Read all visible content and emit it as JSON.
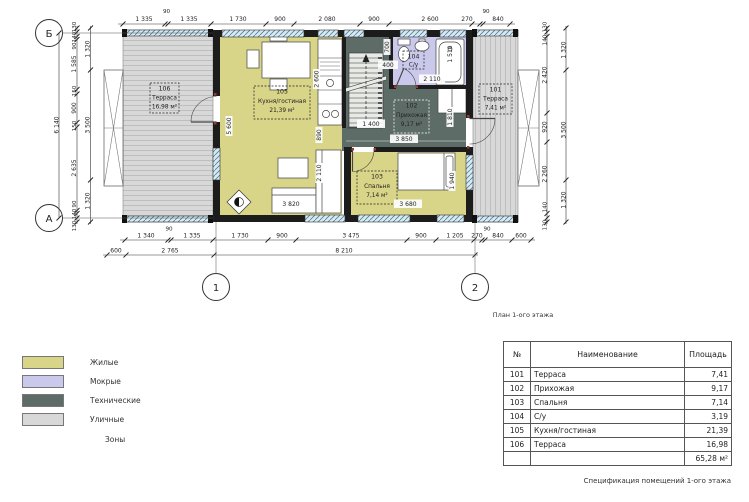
{
  "plan": {
    "caption": "План 1-ого этажа",
    "axes": {
      "row_top": "Б",
      "row_bottom": "А",
      "col_left": "1",
      "col_right": "2"
    },
    "rooms": [
      {
        "num": "101",
        "name": "Терраса",
        "area": "7,41 м²"
      },
      {
        "num": "102",
        "name": "Прихожая",
        "area": "9,17 м²"
      },
      {
        "num": "103",
        "name": "Спальня",
        "area": "7,14 м²"
      },
      {
        "num": "104",
        "name": "С/у",
        "area": ""
      },
      {
        "num": "105",
        "name": "Кухня/гостиная",
        "area": "21,39 м²"
      },
      {
        "num": "106",
        "name": "Терраса",
        "area": "16,98 м²"
      }
    ],
    "dims": {
      "top": [
        "1 335",
        "90",
        "1 335",
        "1 730",
        "900",
        "2 080",
        "900",
        "2 600",
        "270",
        "90",
        "840"
      ],
      "bottom_row1": [
        "1 340",
        "90",
        "1 335",
        "1 730",
        "900",
        "3 475",
        "900",
        "1 205",
        "270",
        "90",
        "840",
        "600"
      ],
      "bottom_row2": [
        "600",
        "2 765",
        "8 210"
      ],
      "left_total": "6 140",
      "left_inner": [
        "130",
        "140",
        "90",
        "1 585",
        "150",
        "900",
        "150",
        "2 635",
        "90",
        "140",
        "130"
      ],
      "left_mid": [
        "1 320",
        "3 500",
        "1 320"
      ],
      "right_inner": [
        "130",
        "140",
        "2 420",
        "920",
        "2 260",
        "140",
        "130"
      ],
      "right_outer": [
        "1 320",
        "3 500",
        "1 320"
      ],
      "interior": [
        "2 600",
        "5 600",
        "890",
        "2 110",
        "3 820",
        "700",
        "400",
        "2 110",
        "1 510",
        "1 400",
        "3 850",
        "1 810",
        "1 940",
        "3 680"
      ]
    }
  },
  "colors": {
    "living": "#d8d488",
    "wet": "#cac9ec",
    "technical": "#5d6c66",
    "outdoor": "#d8d8d8"
  },
  "legend": {
    "items": [
      {
        "label": "Жилые"
      },
      {
        "label": "Мокрые"
      },
      {
        "label": "Технические"
      },
      {
        "label": "Уличные"
      }
    ],
    "caption": "Зоны"
  },
  "spec_table": {
    "headers": [
      "№",
      "Наименование",
      "Площадь"
    ],
    "rows": [
      [
        "101",
        "Терраса",
        "7,41"
      ],
      [
        "102",
        "Прихожая",
        "9,17"
      ],
      [
        "103",
        "Спальня",
        "7,14"
      ],
      [
        "104",
        "С/у",
        "3,19"
      ],
      [
        "105",
        "Кухня/гостиная",
        "21,39"
      ],
      [
        "106",
        "Терраса",
        "16,98"
      ]
    ],
    "total": "65,28 м²",
    "caption": "Спецификация помещений 1-ого этажа"
  }
}
